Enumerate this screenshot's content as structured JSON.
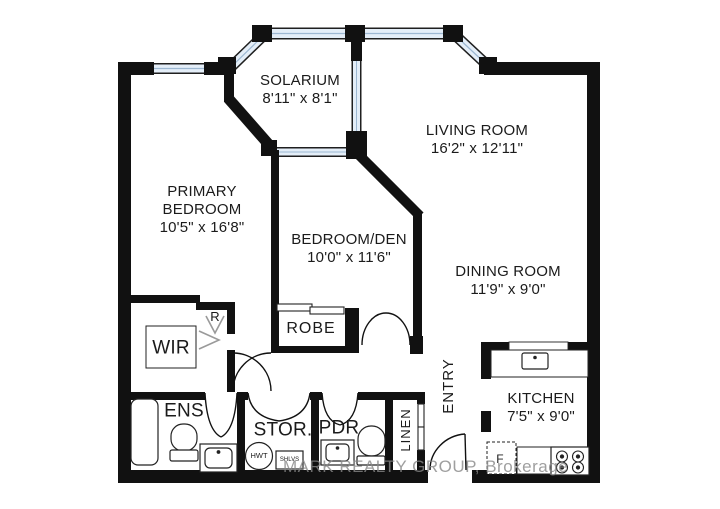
{
  "plan": {
    "watermark": "MARK REALTY GROUP, Brokerage",
    "rooms": {
      "solarium": {
        "name": "SOLARIUM",
        "dims": "8'11\" x 8'1\""
      },
      "living": {
        "name": "LIVING ROOM",
        "dims": "16'2\" x 12'11\""
      },
      "primary": {
        "name": "PRIMARY BEDROOM",
        "dims": "10'5\" x 16'8\""
      },
      "den": {
        "name": "BEDROOM/DEN",
        "dims": "10'0\" x 11'6\""
      },
      "dining": {
        "name": "DINING ROOM",
        "dims": "11'9\" x 9'0\""
      },
      "kitchen": {
        "name": "KITCHEN",
        "dims": "7'5\" x 9'0\""
      },
      "wir": {
        "name": "WIR"
      },
      "robe": {
        "name": "ROBE"
      },
      "ens": {
        "name": "ENS"
      },
      "stor": {
        "name": "STOR."
      },
      "pdr": {
        "name": "PDR"
      },
      "entry": {
        "name": "ENTRY"
      },
      "linen": {
        "name": "LINEN"
      },
      "r_closet": {
        "name": "R"
      }
    },
    "fixtures": {
      "hwt": "HWT",
      "shlvs": "SHLVS",
      "fridge": "F"
    },
    "colors": {
      "wall": "#111111",
      "window_fill": "#e4eef8",
      "window_mullion": "#9db8d2",
      "window_frame": "#1f1f1f"
    }
  }
}
